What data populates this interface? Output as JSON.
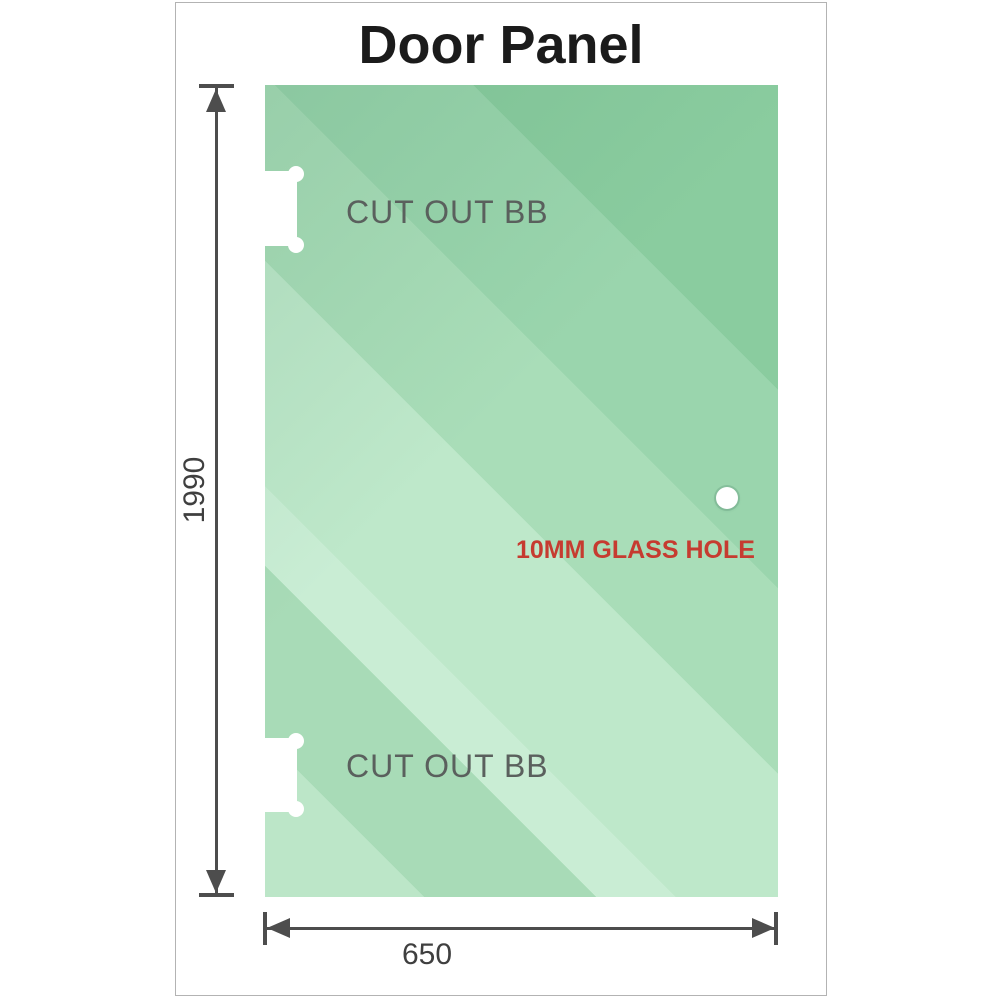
{
  "title": "Door Panel",
  "panel": {
    "cutout_top_label": "CUT OUT BB",
    "cutout_bottom_label": "CUT OUT BB",
    "glass_hole_label": "10MM GLASS HOLE"
  },
  "dimensions": {
    "height_value": "1990",
    "width_value": "650"
  },
  "colors": {
    "glass_base": "#9dd6b0",
    "glass_light_streak": "#c9edd4",
    "glass_dark_corner": "#8acc9f",
    "dimension_line": "#4d4d4d",
    "cutout_label_text": "#5a605d",
    "glass_hole_label_text": "#c63b30",
    "title_text": "#1b1b1b",
    "frame_border": "#b3b3b3"
  }
}
